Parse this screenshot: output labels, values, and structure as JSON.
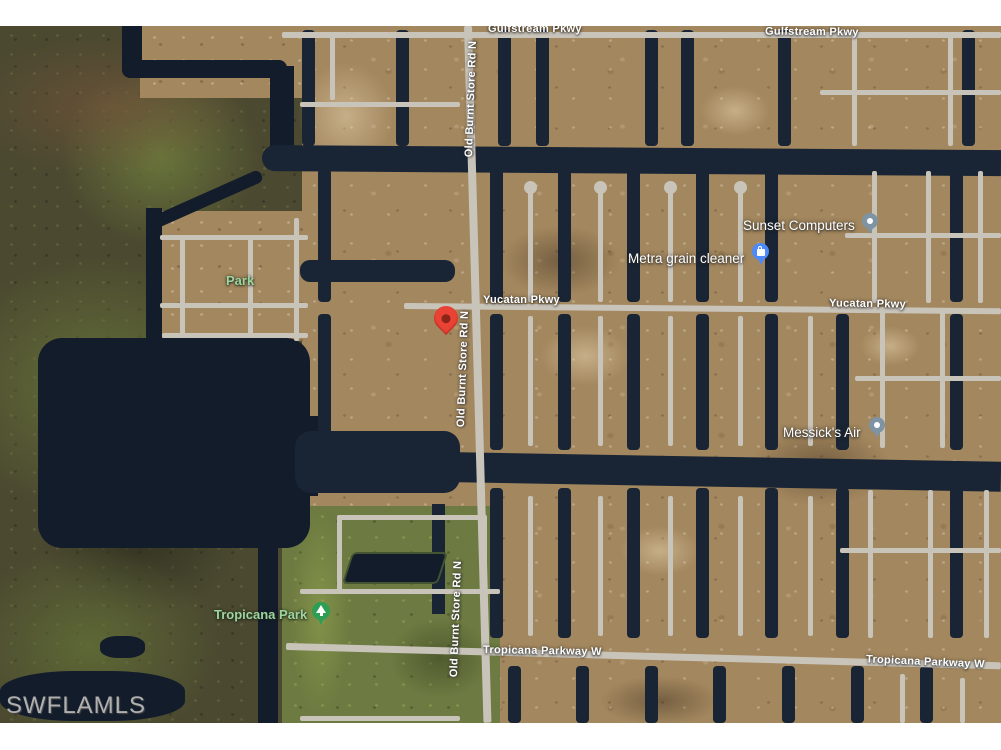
{
  "map": {
    "type": "satellite-aerial-view",
    "watermark": "SWFLAMLS",
    "road_labels": [
      {
        "id": "gulfstream-pkwy-left",
        "text": "Gulfstream Pkwy"
      },
      {
        "id": "gulfstream-pkwy-right",
        "text": "Gulfstream Pkwy"
      },
      {
        "id": "yucatan-pkwy-left",
        "text": "Yucatan Pkwy"
      },
      {
        "id": "yucatan-pkwy-right",
        "text": "Yucatan Pkwy"
      },
      {
        "id": "old-burnt-store-rd-n-top",
        "text": "Old Burnt Store Rd N"
      },
      {
        "id": "old-burnt-store-rd-n-middle",
        "text": "Old Burnt Store Rd N"
      },
      {
        "id": "old-burnt-store-rd-n-bottom",
        "text": "Old Burnt Store Rd N"
      },
      {
        "id": "tropicana-parkway-w-left",
        "text": "Tropicana Parkway W"
      },
      {
        "id": "tropicana-parkway-w-right",
        "text": "Tropicana Parkway W"
      }
    ],
    "park_labels": [
      {
        "id": "park",
        "text": "Park"
      },
      {
        "id": "tropicana-park",
        "text": "Tropicana Park"
      }
    ],
    "pois": [
      {
        "name": "Sunset Computers",
        "icon": "gray-dot-pin"
      },
      {
        "name": "Metra grain cleaner",
        "icon": "blue-shopping-bag-pin"
      },
      {
        "name": "Messick's Air",
        "icon": "gray-dot-pin"
      }
    ],
    "marker": {
      "name": "red-location-pin"
    },
    "colors": {
      "marker_red": "#EA4335",
      "poi_pin_blue": "#4D8AF8",
      "poi_pin_gray": "#7E93A3",
      "park_pin_green": "#2F9E55",
      "park_label_green": "#9ED49D",
      "road_label_white": "#FFFFFF",
      "water_dark": "#131C2B",
      "land_tan": "#A3875E",
      "road_gray": "#C9C4BA",
      "marsh_olive": "#4B4930",
      "park_grass_green": "#6D7A41",
      "watermark_gray": "#B0B0B0"
    }
  }
}
